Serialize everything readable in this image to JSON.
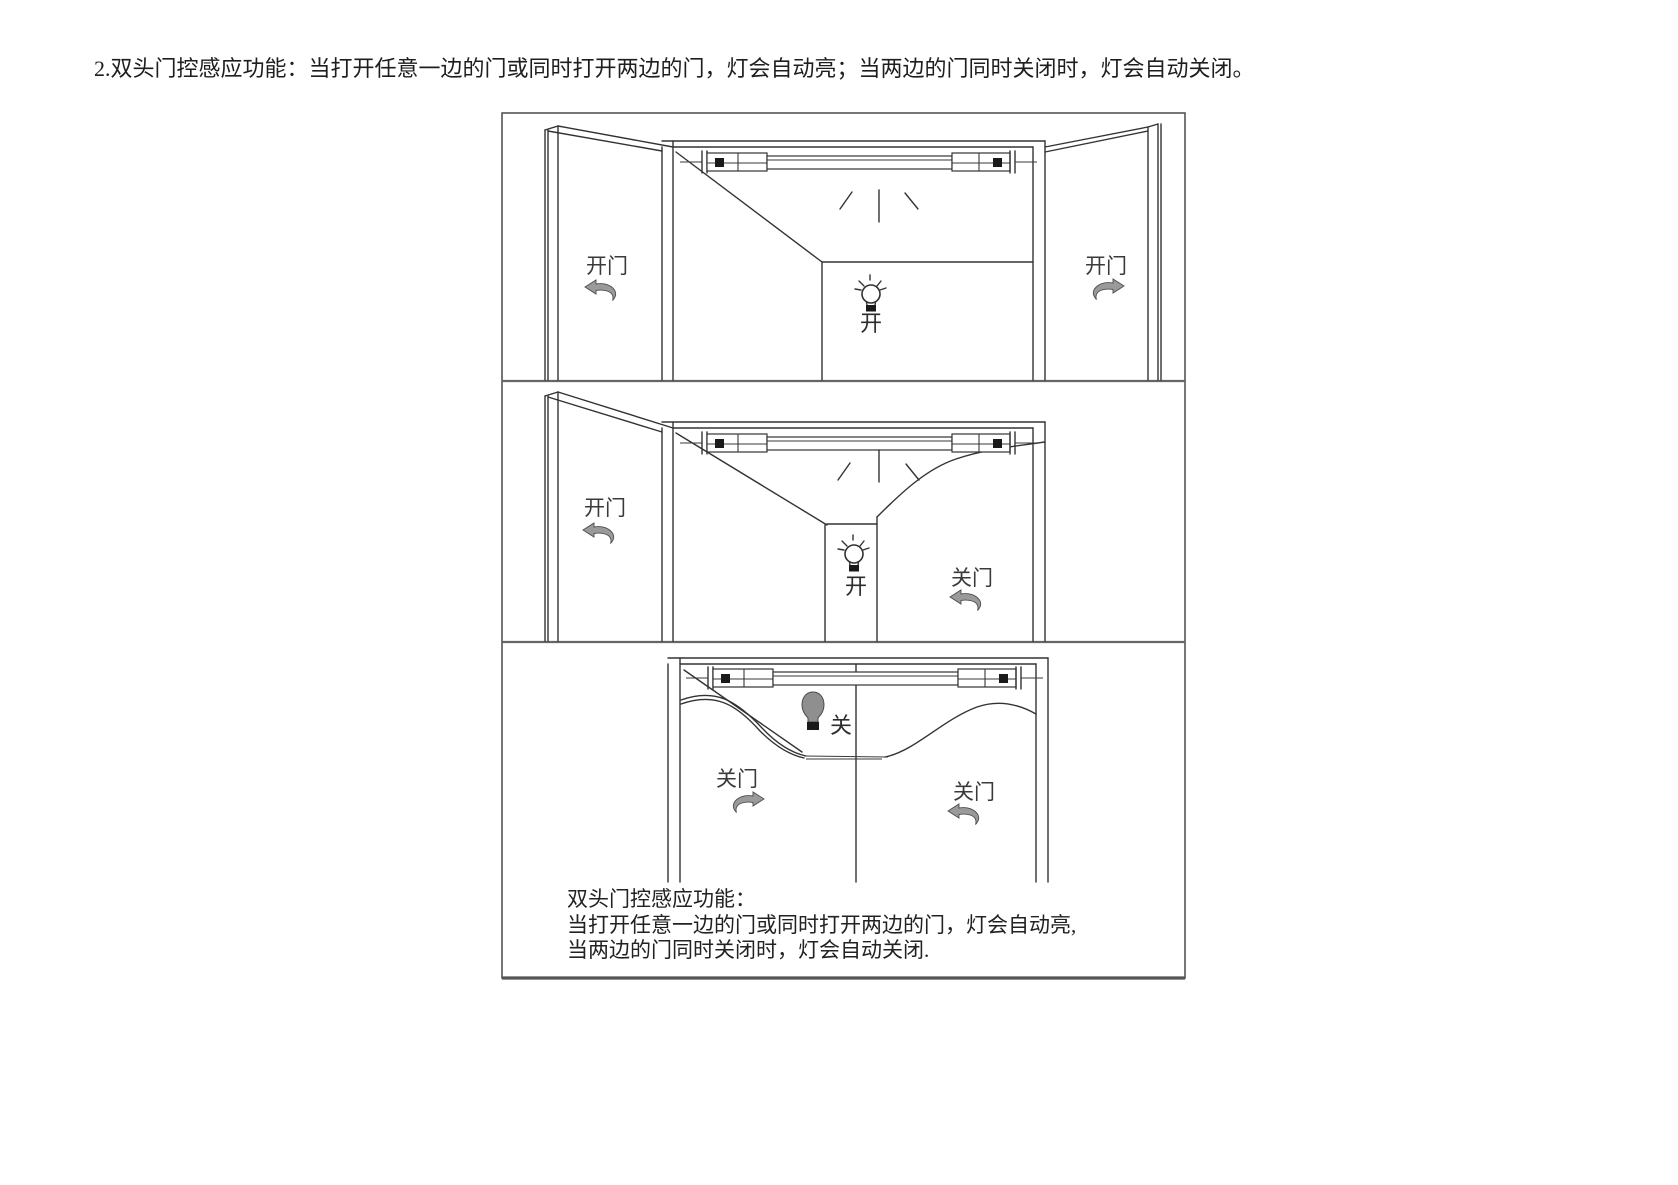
{
  "heading": "2.双头门控感应功能：当打开任意一边的门或同时打开两边的门，灯会自动亮；当两边的门同时关闭时，灯会自动关闭。",
  "panels": {
    "p1": {
      "left_label": "开门",
      "right_label": "开门",
      "bulb_label": "开"
    },
    "p2": {
      "left_label": "开门",
      "right_label": "关门",
      "bulb_label": "开"
    },
    "p3": {
      "left_label": "关门",
      "right_label": "关门",
      "bulb_label": "关"
    }
  },
  "caption": {
    "line1": "双头门控感应功能：",
    "line2": "当打开任意一边的门或同时打开两边的门，灯会自动亮,",
    "line3": "当两边的门同时关闭时，灯会自动关闭."
  },
  "colors": {
    "line": "#333333",
    "arrow_fill": "#9a9a9a",
    "bulb_off_fill": "#8f8f8f",
    "text": "#3a3a3a",
    "background": "#ffffff"
  }
}
